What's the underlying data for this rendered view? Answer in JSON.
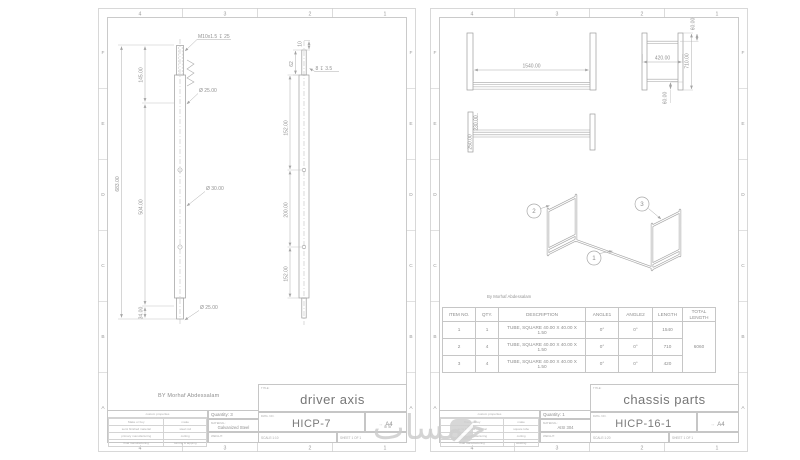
{
  "zones": {
    "letters": [
      "F",
      "E",
      "D",
      "C",
      "B",
      "A"
    ],
    "numbers": [
      "4",
      "3",
      "2",
      "1"
    ]
  },
  "watermark": {
    "text": "خمسات"
  },
  "left_sheet": {
    "author_note": "BY Morhaf Abdessalam",
    "dims": {
      "thread_callout": "M10x1.5 ↧ 25",
      "dia_top": "Ø 25.00",
      "dia_mid": "Ø 30.00",
      "dia_bottom": "Ø 25.00",
      "overall": "683.00",
      "seg_top": "145.00",
      "seg_mid": "504.00",
      "seg_bottom": "34.00",
      "side_top": "10",
      "side_stub": "62",
      "hole_callout": "8 ↧ 3.5",
      "chain_top": "152.00",
      "chain_mid": "200.00",
      "chain_bottom": "152.00"
    },
    "title_block": {
      "title_label": "TITLE:",
      "title": "driver axis",
      "dwg_label": "DWG. NO.",
      "dwg_no": "HICP-7",
      "size": "A4",
      "quantity": "Quantity: 3",
      "material_label": "MATERIAL:",
      "material": "Galvanized Steel",
      "weight_label": "WEIGHT:",
      "scale": "SCALE:1:10",
      "sheet": "SHEET 1 OF 1",
      "props_header": "custom properties",
      "props": [
        {
          "label": "Make or buy",
          "value": "make"
        },
        {
          "label": "semi finished material",
          "value": "steel rod"
        },
        {
          "label": "primary manufacturing",
          "value": "cutting"
        },
        {
          "label": "final manufacturing",
          "value": "turning & tapping"
        }
      ]
    }
  },
  "right_sheet": {
    "author_note": "By Morhaf Abdessalam",
    "dims": {
      "front_width": "1540.00",
      "side_width": "420.00",
      "side_height": "710.00",
      "side_top": "60.00",
      "side_bottom": "60.00",
      "bottom_a": "230.00",
      "bottom_b": "250.00"
    },
    "balloons": {
      "b1": "1",
      "b2": "2",
      "b3": "3"
    },
    "bom": {
      "headers": [
        "ITEM NO.",
        "QTY.",
        "DESCRIPTION",
        "ANGLE1",
        "ANGLE2",
        "LENGTH",
        "TOTAL LENGTH"
      ],
      "rows": [
        {
          "item": "1",
          "qty": "1",
          "desc": "TUBE, SQUARE 40.00 X 40.00 X 1.50",
          "angle1": "0°",
          "angle2": "0°",
          "length": "1540"
        },
        {
          "item": "2",
          "qty": "4",
          "desc": "TUBE, SQUARE 40.00 X 40.00 X 1.50",
          "angle1": "0°",
          "angle2": "0°",
          "length": "710"
        },
        {
          "item": "3",
          "qty": "4",
          "desc": "TUBE, SQUARE 40.00 X 40.00 X 1.50",
          "angle1": "0°",
          "angle2": "0°",
          "length": "420"
        }
      ],
      "total_length": "6060"
    },
    "title_block": {
      "title_label": "TITLE:",
      "title": "chassis parts",
      "dwg_label": "DWG. NO.",
      "dwg_no": "HICP-16-1",
      "size": "A4",
      "quantity": "Quantity: 1",
      "material_label": "MATERIAL:",
      "material": "AISI 304",
      "weight_label": "WEIGHT:",
      "scale": "SCALE:1:20",
      "sheet": "SHEET 1 OF 1",
      "props_header": "custom properties",
      "props": [
        {
          "label": "Make or buy",
          "value": "make"
        },
        {
          "label": "semi finished material",
          "value": "square tube"
        },
        {
          "label": "primary manufacturing",
          "value": "cutting"
        },
        {
          "label": "final manufacturing",
          "value": "welding"
        }
      ]
    }
  }
}
